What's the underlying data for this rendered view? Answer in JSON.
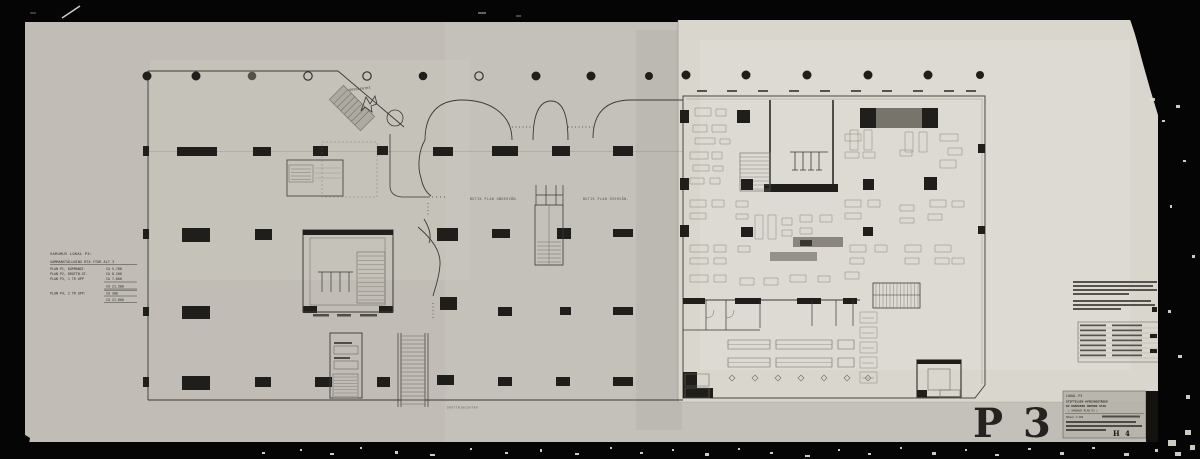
{
  "sheet": {
    "stamp_code": "P 3",
    "titleblock_mark": "H 4"
  },
  "legend": {
    "title": "VARUHUS LOKAL P3:",
    "subtitle": "SAMMANSTÄLLNING BTA YTOR ALT 3",
    "rows": [
      {
        "label": "PLAN P1, KÖPMANGT.",
        "value": "CA  5.700"
      },
      {
        "label": "PLAN P2, DROTTN.GT.",
        "value": "CA  8.200"
      },
      {
        "label": "PLAN P3, 1 TR UPP",
        "value": "CA  7.600"
      }
    ],
    "subtotal": "CA 21.500",
    "extra_row": {
      "label": "PLAN P4, 2 TR UPP:",
      "value": "CA    300"
    },
    "total": "CA 21.800"
  },
  "plan": {
    "entrance_label": "HUVUDENTRÉ",
    "label_left": "BUTIK PLAN UNDERVÅN.",
    "label_right": "BUTIK PLAN ÖVERVÅN.",
    "street_label": "DROTTNINGGATAN"
  },
  "title_block": {
    "line1": "LOKAL  P3",
    "line2": "STIFTELSEN HYRESBOSTÄDER",
    "line3": "KV KRÄMAREN ÖREBRO STAD",
    "line4": "( VARUHUS  PLAN P3 )",
    "scale": "SKALA 1:200"
  },
  "colors": {
    "paper_left": "#c4c1ba",
    "paper_right": "#d9d6ce",
    "ink": "#3b3935",
    "frame": "#050505"
  }
}
